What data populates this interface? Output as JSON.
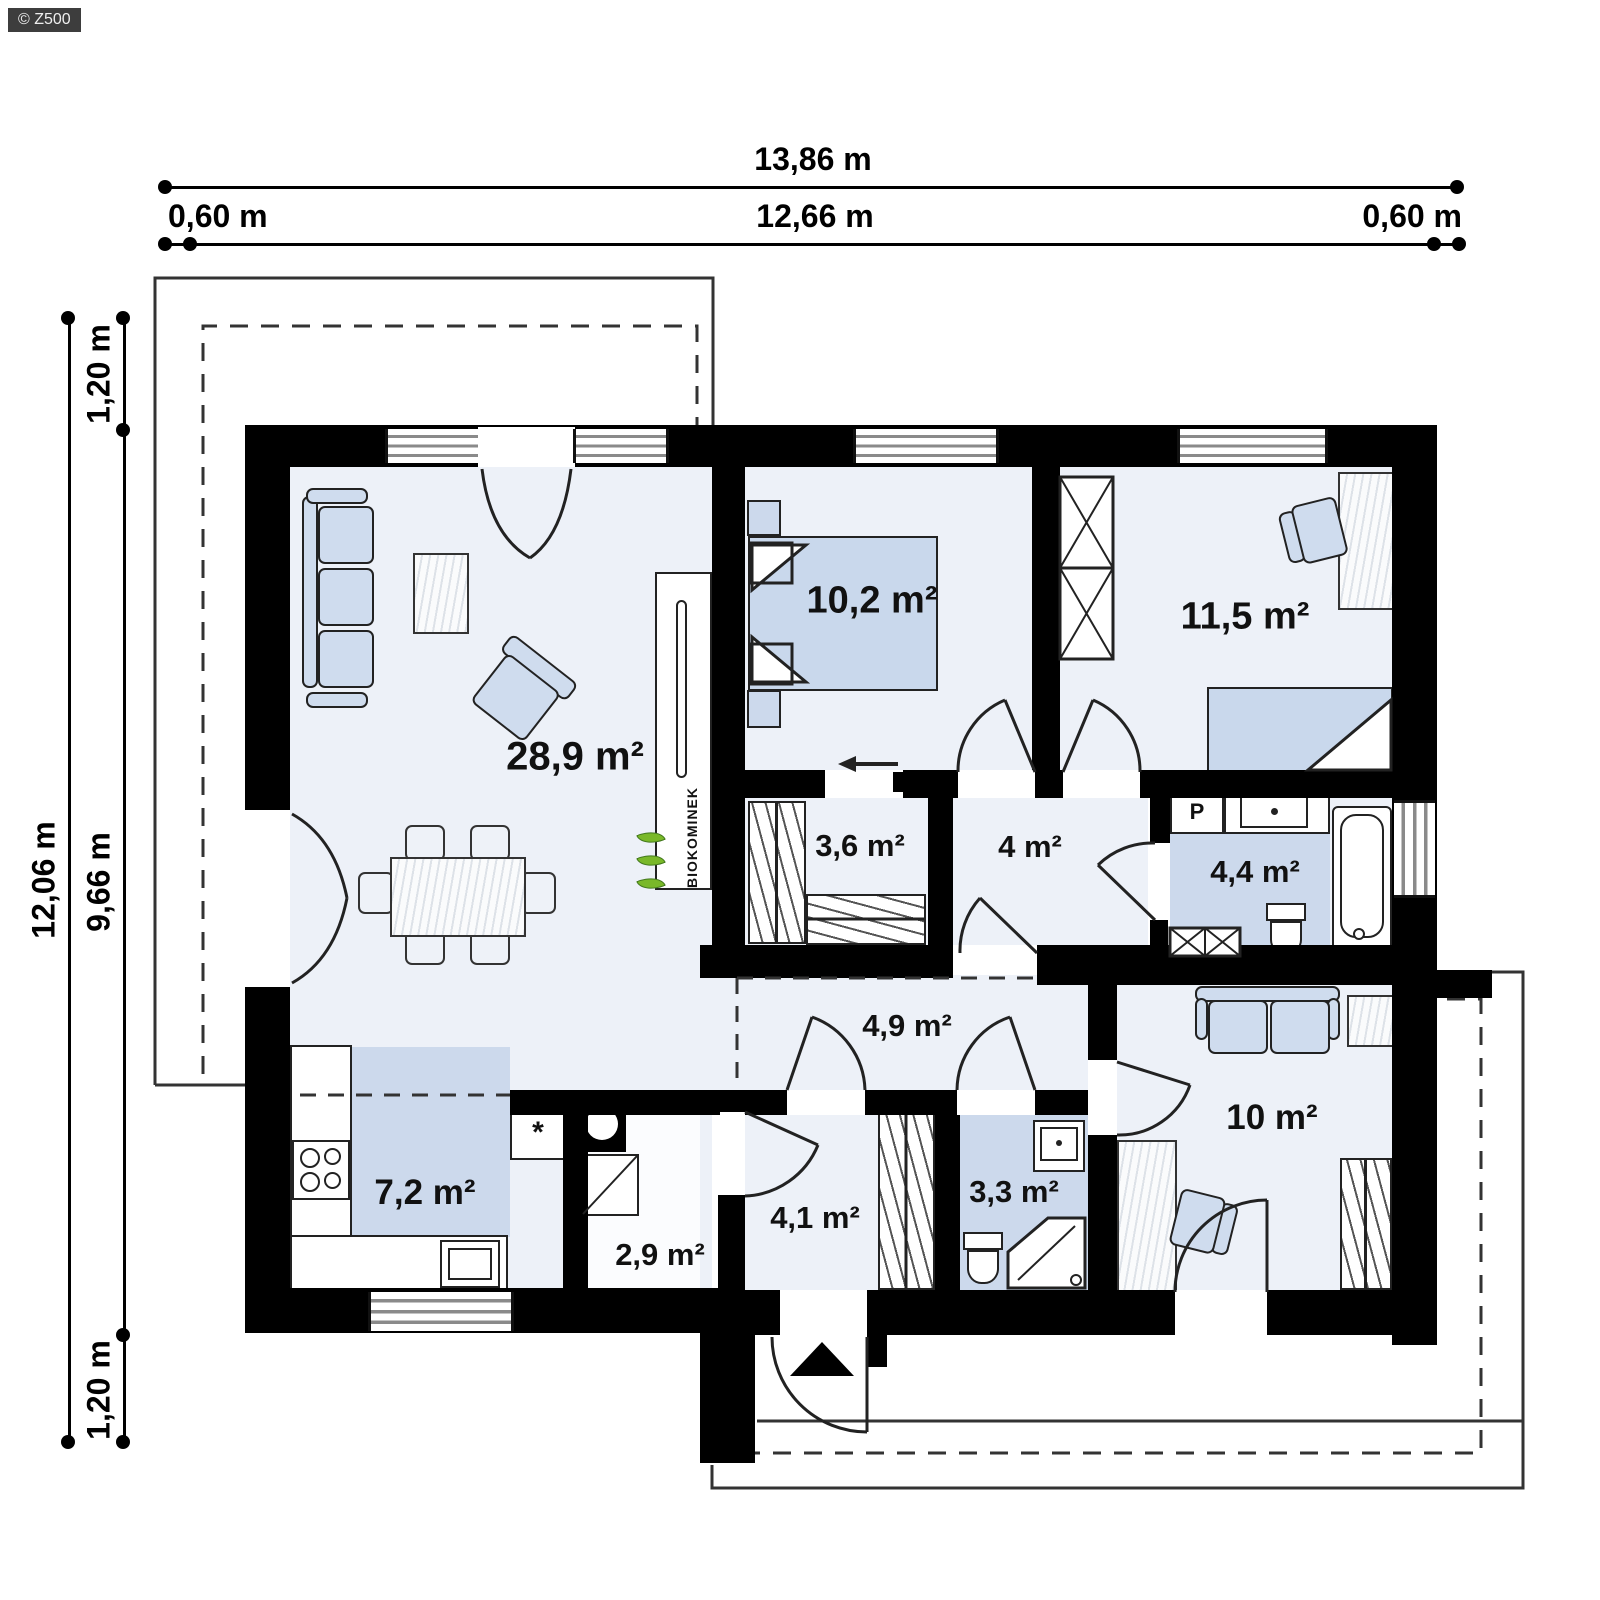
{
  "watermark": "© Z500",
  "dimensions": {
    "top_total": "13,86 m",
    "top_inner": "12,66 m",
    "top_left_margin": "0,60 m",
    "top_right_margin": "0,60 m",
    "left_total": "12,06 m",
    "left_inner": "9,66 m",
    "left_top_margin": "1,20 m",
    "left_bottom_margin": "1,20 m"
  },
  "rooms": [
    {
      "name": "living-dining-room",
      "area": "28,9 m²"
    },
    {
      "name": "bedroom-1",
      "area": "10,2 m²"
    },
    {
      "name": "bedroom-2",
      "area": "11,5 m²"
    },
    {
      "name": "walk-in-closet",
      "area": "3,6 m²"
    },
    {
      "name": "hall",
      "area": "4 m²"
    },
    {
      "name": "bathroom",
      "area": "4,4 m²"
    },
    {
      "name": "corridor",
      "area": "4,9 m²"
    },
    {
      "name": "room",
      "area": "10 m²"
    },
    {
      "name": "kitchen",
      "area": "7,2 m²"
    },
    {
      "name": "utility-room",
      "area": "2,9 m²"
    },
    {
      "name": "entrance-hall",
      "area": "4,1 m²"
    },
    {
      "name": "shower-room",
      "area": "3,3 m²"
    }
  ],
  "labels": {
    "fireplace": "BIOKOMINEK",
    "washing_machine": "P",
    "asterisk": "*"
  },
  "colors": {
    "wall": "#000000",
    "floor": "#edf1f8",
    "accent_floor": "#ccd9ec",
    "leaf_green": "#79b829"
  }
}
